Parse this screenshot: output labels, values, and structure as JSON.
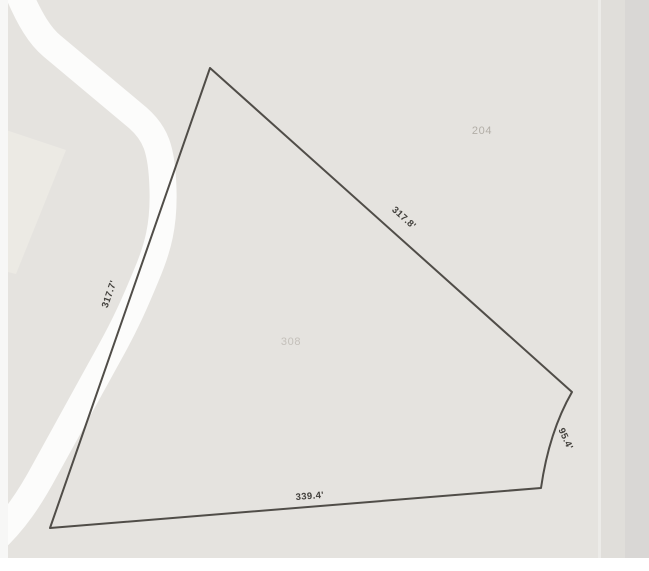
{
  "map": {
    "colors": {
      "background": "#e5e3df",
      "road": "#fcfcfb",
      "edge_strip_inner": "#e0deda",
      "edge_strip_outer": "#d9d7d5",
      "adjacent_shading": "#eceae4",
      "parcel_line": "#504d48",
      "dimension_label": "#413f3b",
      "parcel_number_north": "#b2aea7",
      "parcel_number_main": "#c4c0ba"
    },
    "parcel": {
      "dimensions": {
        "northeast_edge": "317.8'",
        "west_edge": "317.7'",
        "south_edge": "339.4'",
        "east_edge": "95.4'"
      },
      "numbers": {
        "north_parcel": "204",
        "main_parcel": "308"
      }
    }
  }
}
